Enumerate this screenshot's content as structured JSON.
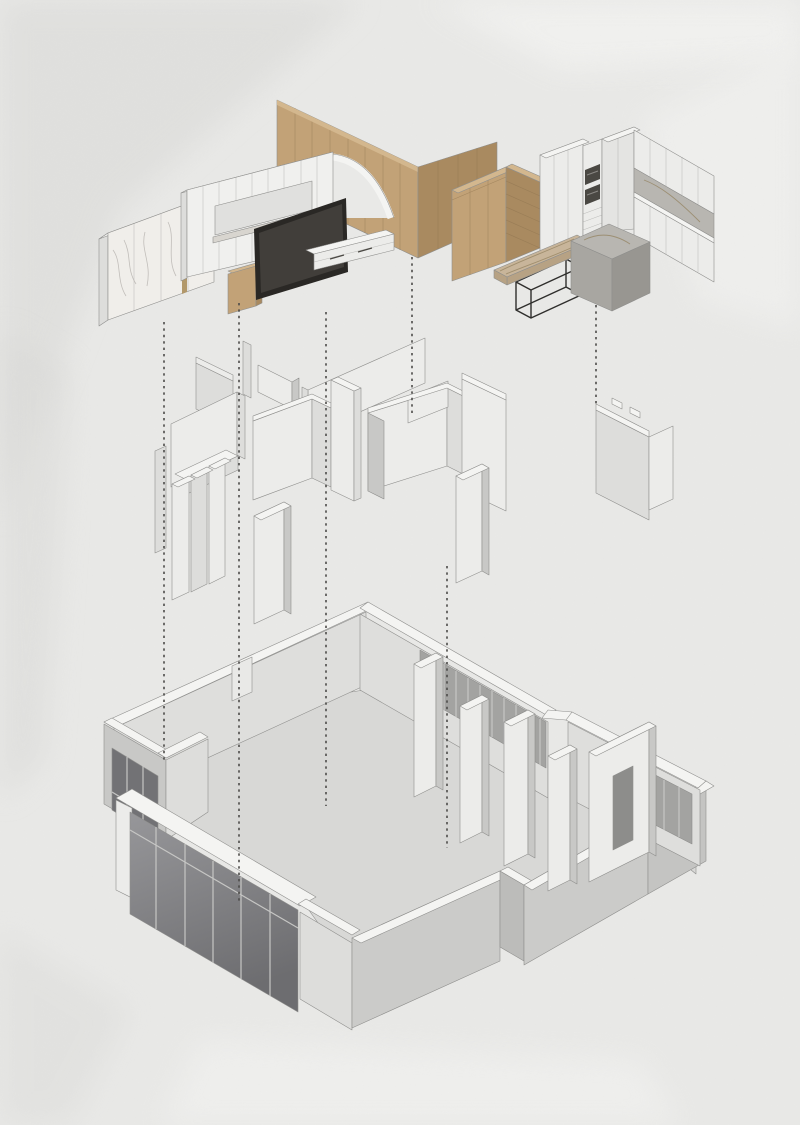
{
  "document": {
    "type": "exploded-axonometric-interior-design-diagram",
    "background": "#e9e9e7",
    "canvas": {
      "width": 800,
      "height": 1125
    },
    "visible_text": ""
  },
  "palette": {
    "bg": "#e9e9e7",
    "wash_dark": "#d9d9d7",
    "wash_light": "#f3f3f1",
    "line": "#8f8f8d",
    "wall_top": "#f4f4f2",
    "wall_light": "#ececea",
    "wall_mid": "#dddddb",
    "wall_dark": "#c8c8c6",
    "wall_shade": "#bcbcba",
    "floor": "#d8d8d6",
    "inner_wall": "#dededc",
    "glass": "#8c8c8f",
    "glass_dark": "#727275",
    "glass_frame": "#c6c6c4",
    "win_band": "#a3a3a1",
    "wood_light": "#d3b78e",
    "wood": "#c2a277",
    "wood_dark": "#a98a60",
    "wood_line": "#8f7450",
    "marble": "#f0eeea",
    "marble_vein": "#b5b2ae",
    "gold": "#b2986a",
    "tv_frame": "#2a2825",
    "tv_screen": "#413e3a",
    "appliance": "#4a4843",
    "stone_light": "#b8b6b1",
    "stone": "#a8a6a1",
    "stone_dark": "#989691",
    "slab": "#c8b59a",
    "slab_edge": "#b7a284",
    "slab_vein": "#93815f",
    "metal": "#2f2e2c",
    "dash": "#4c4b49"
  },
  "scene": {
    "layers": [
      {
        "id": "furniture-finishes",
        "position": "top",
        "components": [
          "marble-panel-wall",
          "gold-inlay-strip",
          "tv-feature-wall",
          "wall-niche",
          "tv-side-cabinet",
          "tv-screen",
          "media-console",
          "wood-slat-wall",
          "arched-opening",
          "wardrobe-cabinet",
          "open-shelf-unit",
          "kitchen-tall-cabinets",
          "built-in-ovens",
          "kitchen-upper-cabinets",
          "stone-backsplash",
          "kitchen-base-cabinets",
          "kitchen-island",
          "dining-table-slab",
          "metal-table-base"
        ]
      },
      {
        "id": "partition-walls",
        "position": "middle",
        "components": [
          "back-panel",
          "corner-bracket",
          "long-back-wall",
          "left-room-walls",
          "wall-pillars",
          "front-partition-wall",
          "center-room-walls",
          "center-partition-wall",
          "u-shaped-room-walls",
          "right-tall-wall",
          "freestanding-pillar",
          "entry-wall-panel"
        ]
      },
      {
        "id": "structural-shell",
        "position": "bottom",
        "components": [
          "floor-slab",
          "top-left-wall",
          "doorway-notch",
          "window-bay",
          "bay-window-glass",
          "curtain-wall-glazing",
          "front-bottom-wall",
          "step-block",
          "right-wing-walls",
          "top-right-wall",
          "window-openings",
          "interior-wall-stubs"
        ]
      }
    ],
    "connectors": {
      "style": "dashed",
      "color_key": "dash",
      "count": 6
    }
  }
}
